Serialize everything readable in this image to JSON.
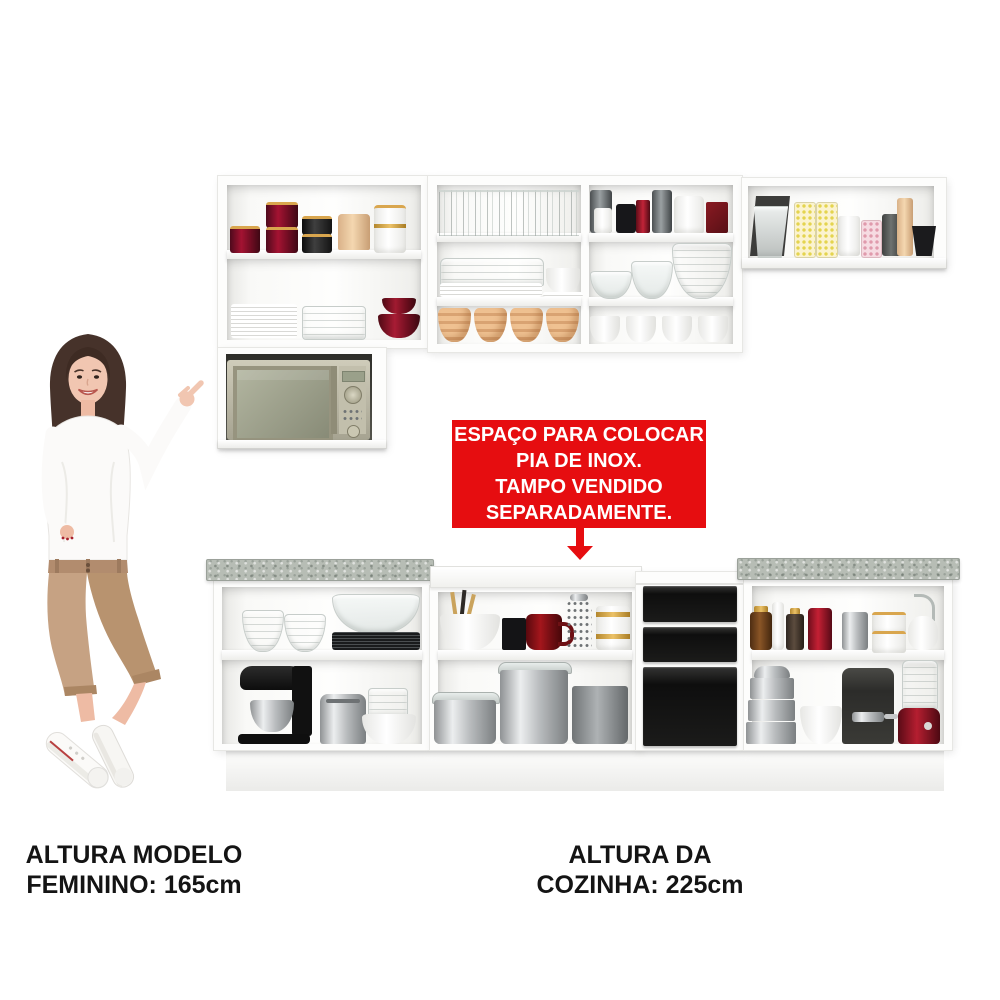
{
  "callout": {
    "lines": [
      "ESPAÇO PARA COLOCAR",
      "PIA DE INOX.",
      "TAMPO VENDIDO",
      "SEPARADAMENTE."
    ],
    "background_color": "#e60d10",
    "text_color": "#ffffff"
  },
  "captions": {
    "model_height": {
      "line1": "ALTURA MODELO",
      "line2": "FEMININO: 165cm"
    },
    "kitchen_height": {
      "line1": "ALTURA DA",
      "line2": "COZINHA: 225cm"
    }
  },
  "colors": {
    "cabinet_white": "#fdfdfc",
    "countertop_granite": "#b7bdb5",
    "drawer_front_black": "#181818",
    "accent_red": "#e60d10",
    "caption_text": "#141414"
  }
}
